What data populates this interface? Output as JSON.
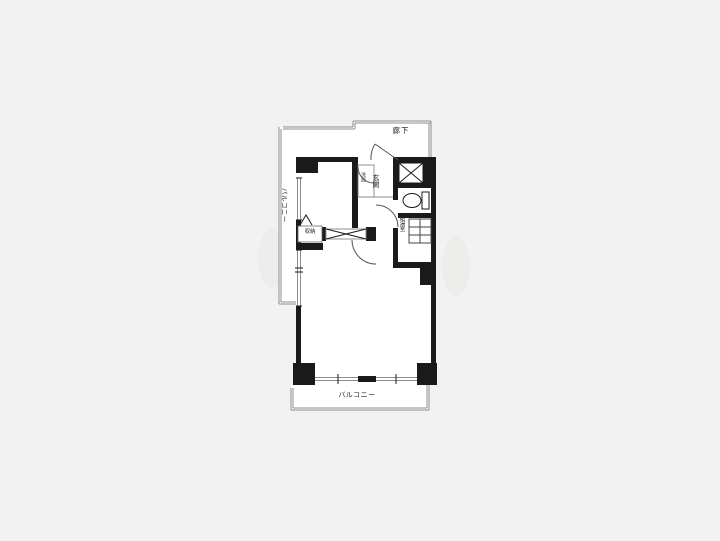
{
  "colors": {
    "bg": "#f2f2f2",
    "paper": "#ffffff",
    "wall": "#1a1a1a",
    "thin": "#8c8c8c",
    "ink": "#222222",
    "arc": "#555555"
  },
  "floorplan": {
    "labels": {
      "corridor": "廊下",
      "entrance": "玄関",
      "washroom": "洗面",
      "kitchenette": "給湯室",
      "storage": "収納",
      "balcony_left": "バルコニー",
      "balcony_bottom": "バルコニー"
    },
    "icons": [
      "shaft-x-icon",
      "toilet-icon",
      "counter-grid-icon",
      "sliding-door-icon",
      "door-swing-arc",
      "folding-door-mark",
      "window-line",
      "railing-line"
    ]
  }
}
